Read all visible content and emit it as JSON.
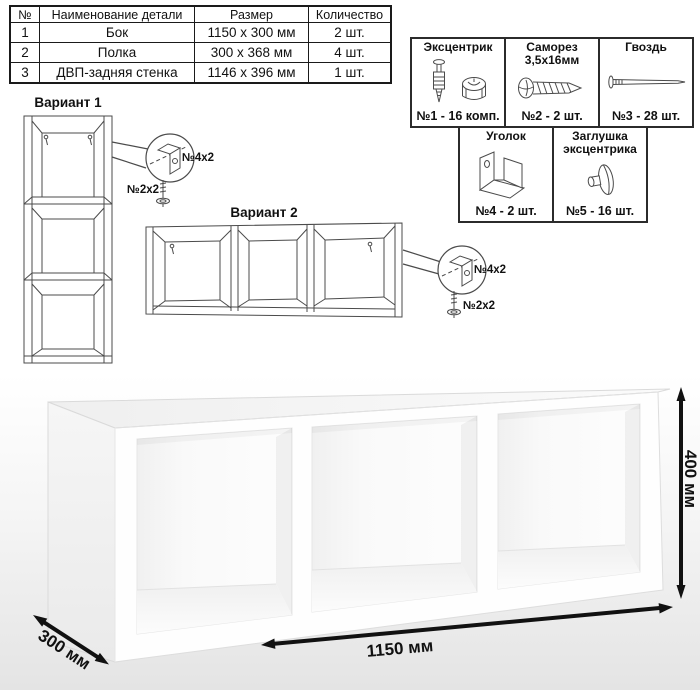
{
  "parts_table": {
    "headers": [
      "№",
      "Наименование детали",
      "Размер",
      "Количество"
    ],
    "rows": [
      [
        "1",
        "Бок",
        "1150 x 300 мм",
        "2 шт."
      ],
      [
        "2",
        "Полка",
        "300 x 368 мм",
        "4 шт."
      ],
      [
        "3",
        "ДВП-задняя стенка",
        "1146 x 396 мм",
        "1 шт."
      ]
    ]
  },
  "hardware": {
    "items": [
      {
        "name": "Эксцентрик",
        "qty": "№1 - 16 комп.",
        "icon": "eccentric-icon"
      },
      {
        "name": "Саморез",
        "spec": "3,5x16мм",
        "qty": "№2 - 2 шт.",
        "icon": "screw-icon"
      },
      {
        "name": "Гвоздь",
        "qty": "№3 - 28 шт.",
        "icon": "nail-icon"
      },
      {
        "name": "Уголок",
        "qty": "№4 - 2 шт.",
        "icon": "corner-bracket-icon"
      },
      {
        "name": "Заглушка эксцентрика",
        "qty": "№5 - 16 шт.",
        "icon": "eccentric-cap-icon"
      }
    ]
  },
  "variants": {
    "v1": {
      "title": "Вариант 1",
      "bracket_label": "№4x2",
      "screw_label": "№2x2"
    },
    "v2": {
      "title": "Вариант 2",
      "bracket_label": "№4x2",
      "screw_label": "№2x2"
    }
  },
  "dimensions": {
    "width": "1150 мм",
    "height": "400 мм",
    "depth": "300 мм"
  },
  "colors": {
    "line_art": "#4b4b4b",
    "arrow": "#111111",
    "border": "#1a1a1a"
  }
}
